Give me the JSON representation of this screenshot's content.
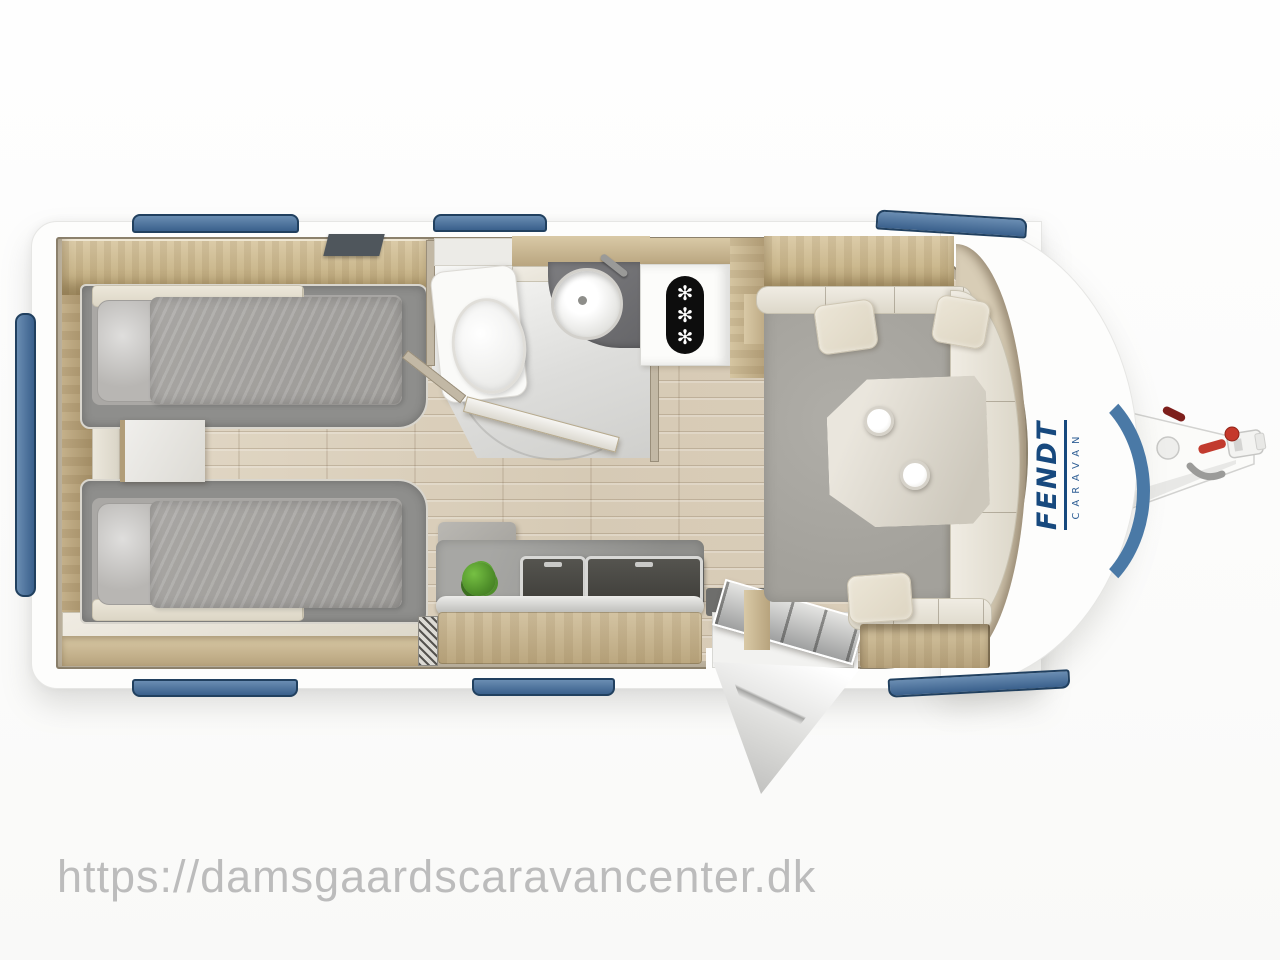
{
  "scene": {
    "watermark_text": "https://damsgaardscaravancenter.dk",
    "brand": {
      "primary": "FENDT",
      "secondary": "CARAVAN"
    },
    "fridge_snowflakes": [
      "✻",
      "✻",
      "✻"
    ]
  },
  "colors": {
    "watermark_grey": "#bcbcbc",
    "body_white": "#fdfdfc",
    "window_blue_top": "#6a8db2",
    "window_blue_bottom": "#3a608c",
    "window_border": "#21405f",
    "trim_blue": "#4a79a6",
    "logo_blue": "#17497e",
    "wall_beige": "#c2b8a5",
    "wood_light": "#d9c9a6",
    "wood_dark": "#b7a37d",
    "floor_base": "#ddd2bf",
    "cushion_grey": "#a9a7a1",
    "mattress_grey": "#aaa8a5",
    "bed_frame_grey": "#8e8e8c",
    "cream": "#e9e4d8",
    "counter_grey": "#9a9a96",
    "counter_dark": "#4c4c4a",
    "plant_green": "#4f8f2a",
    "red_accent": "#c23b2e",
    "black": "#0d0d0d"
  }
}
